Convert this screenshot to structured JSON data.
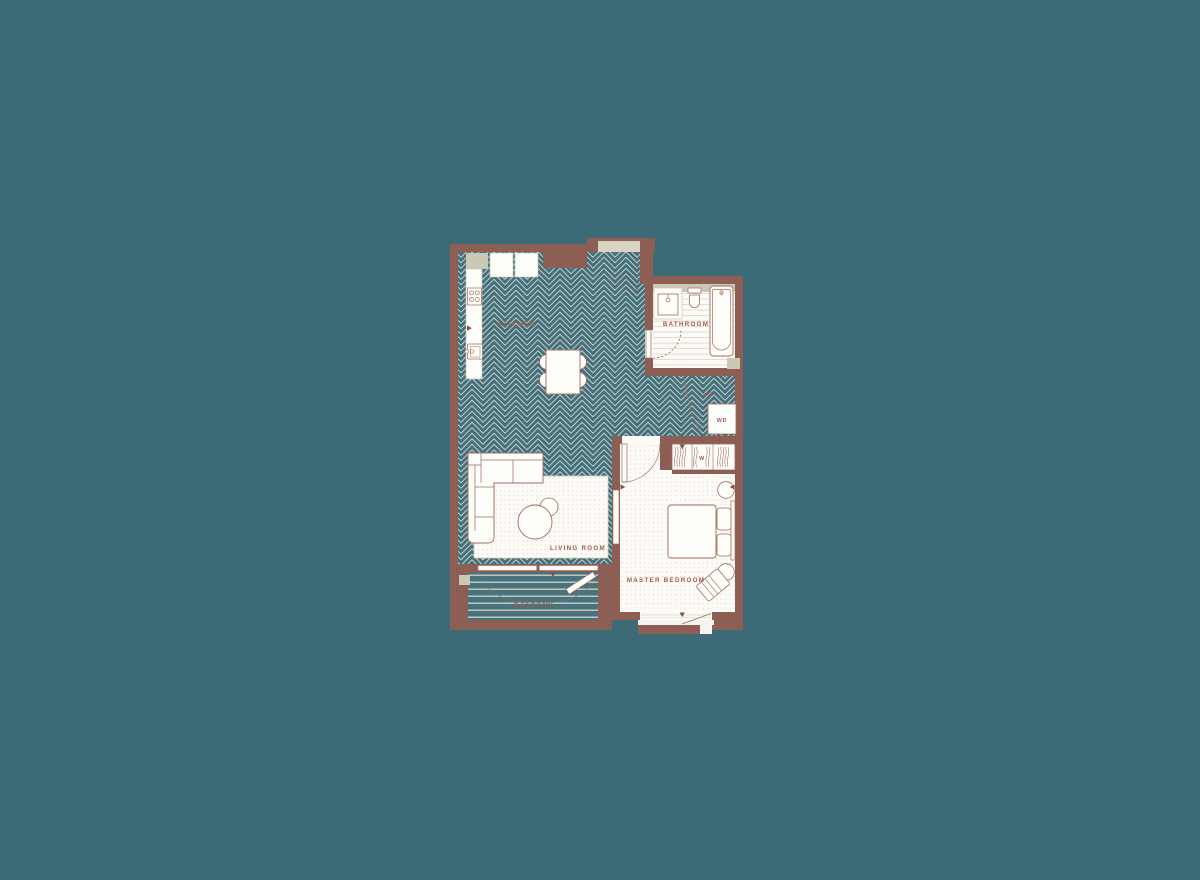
{
  "floorplan": {
    "labels": {
      "kitchen": "KITCHEN",
      "bathroom": "BATHROOM",
      "living_room": "LIVING ROOM",
      "master_bedroom": "MASTER BEDROOM",
      "balcony": "BALCONY",
      "washer_dryer": "WD",
      "utility_cupboard": "UC",
      "wardrobe": "W"
    },
    "palette": {
      "background": "#3d6a77",
      "wall": "#8d5f54",
      "floor_teal": "#41707f",
      "floor_cream": "#d8d4c3",
      "accent_beige": "#cbc9b4",
      "label_color": "#a45a44",
      "furniture_line": "#a06c59",
      "white": "#fdfdfa"
    }
  }
}
